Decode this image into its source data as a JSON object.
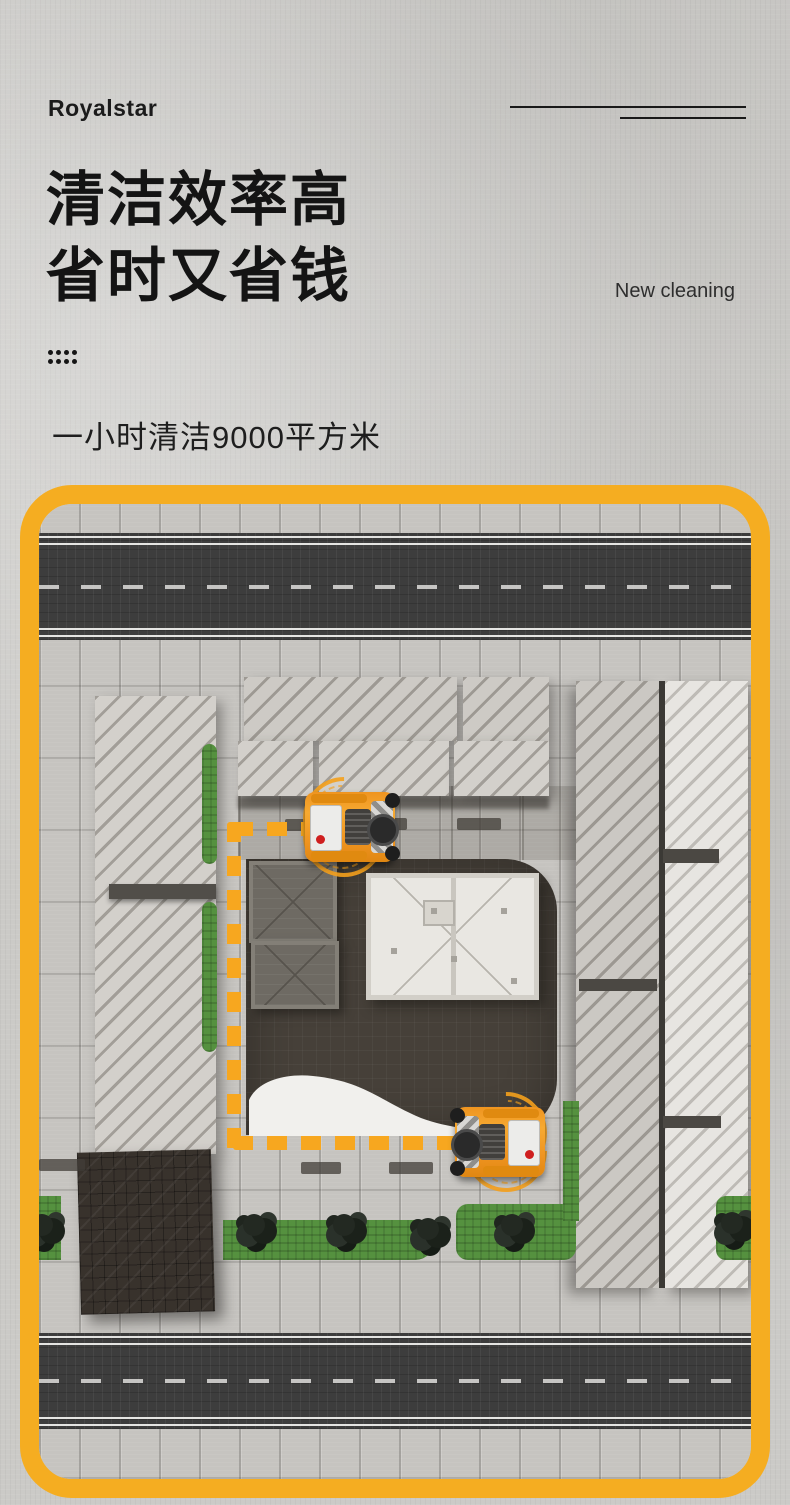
{
  "header": {
    "logo": "Royalstar",
    "tagline": "New cleaning"
  },
  "hero": {
    "title_line1": "清洁效率高",
    "title_line2": "省时又省钱",
    "subtitle": "一小时清洁9000平方米"
  },
  "theme": {
    "accent_yellow": "#F5AD21",
    "route_yellow": "#F7A71F",
    "ink": "#141414",
    "asphalt": "#3D3D3D",
    "pavement": "#C6C4C0",
    "plaza_dark": "#464039",
    "greenery": "#55913F",
    "machine_orange": "#F2992D",
    "alert_red": "#CF1F1F"
  },
  "scene": {
    "icons": [
      "sweeper-machine-icon",
      "cleaning-route-path-icon",
      "tree-icon",
      "grid-dots-icon"
    ]
  }
}
